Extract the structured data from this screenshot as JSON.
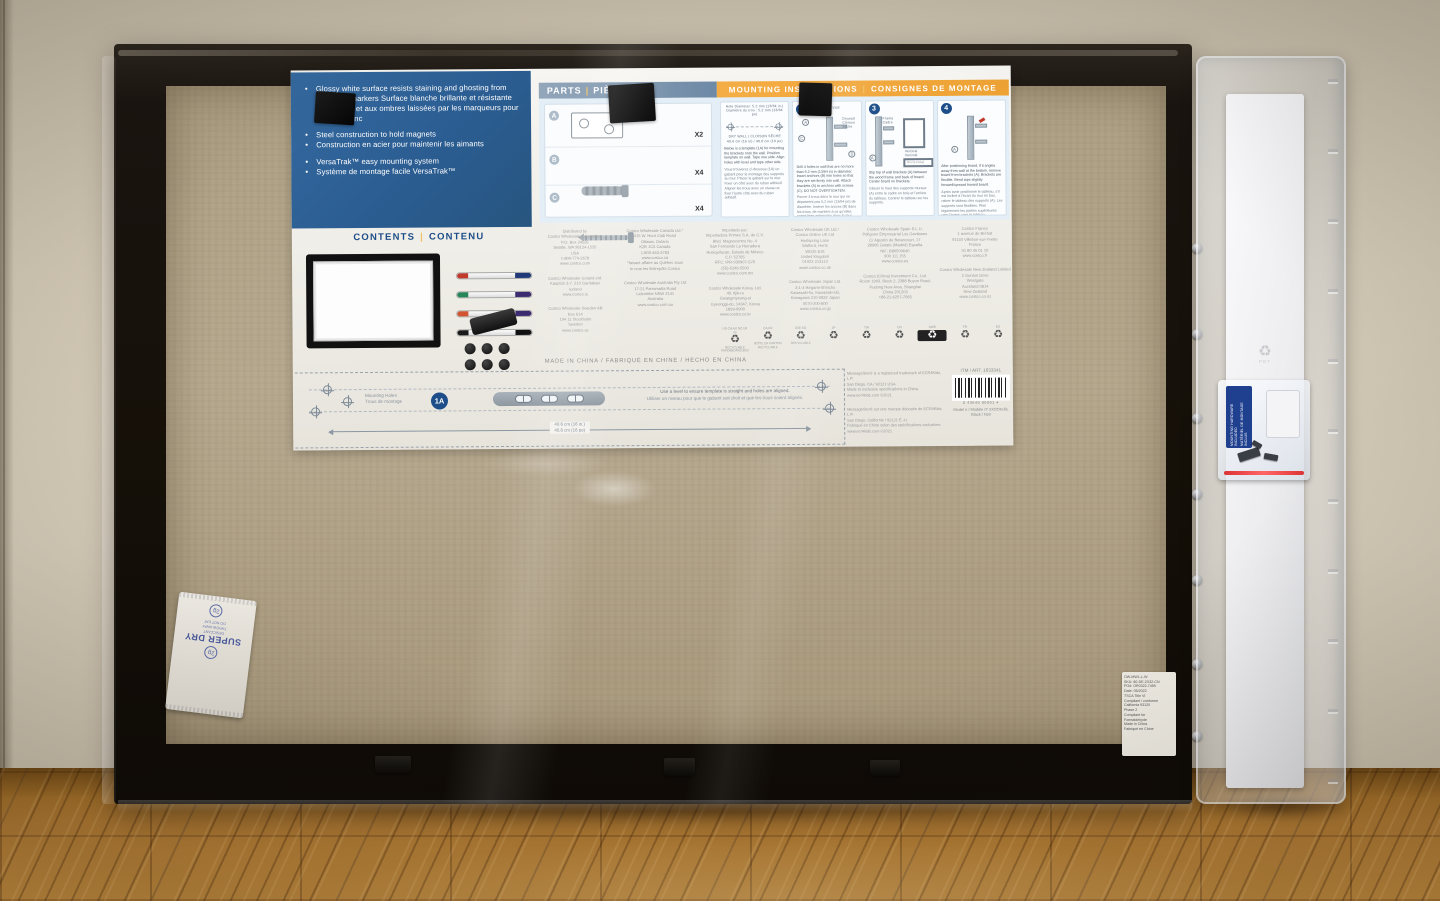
{
  "colors": {
    "panel_blue": "#2d5f95",
    "header_orange": "#f2a93b",
    "navy_accent": "#1d4e89",
    "gold_separator": "#e2a23c",
    "wall": "#cdc3b1",
    "floor_wood": "#a9752f",
    "cardboard_backing": "#b2a48b",
    "frame_black": "#151008"
  },
  "blue_panel": {
    "bullets": [
      "Glossy white surface resists staining and ghosting from dry erase markers  Surface blanche brillante et résistante aux taches et aux ombres laissées par les marqueurs pour tableau blanc",
      "Steel construction to hold magnets",
      "Construction en acier pour maintenir les aimants",
      "VersaTrak™ easy mounting system",
      "Système de montage facile VersaTrak™"
    ]
  },
  "parts": {
    "title_en": "PARTS",
    "sep": "|",
    "title_fr": "PIÈCES",
    "items": [
      {
        "letter": "A",
        "qty": "X2"
      },
      {
        "letter": "B",
        "qty": "X4"
      },
      {
        "letter": "C",
        "qty": "X4"
      }
    ]
  },
  "mounting": {
    "title_en": "MOUNTING INSTRUCTIONS",
    "sep": "|",
    "title_fr": "CONSIGNES DE MONTAGE",
    "step1": {
      "hole_en": "Hole Diameter: 5.2 mm (13/64 in.)",
      "hole_fr": "Diamètre du trou : 5,2 mm (13/64 po)",
      "drywall": "DRY WALL | CLOISON SÈCHE",
      "dim": "40.6 cm (16 in) / 40,6 cm (16 po)",
      "text_en": "Below is a template (1A) for mounting the brackets onto the wall. Position template on wall. Tape one side. Align holes with level and tape other side.",
      "text_fr": "Vous trouverez ci-dessous (1A) un gabarit pour le montage des supports au mur. Placer le gabarit sur le mur. Fixer un côté avec du ruban adhésif. Aligner les trous avec un niveau et fixer l'autre côté avec du ruban adhésif."
    },
    "steps": [
      {
        "num": "2",
        "caption": "SIDE VIEW | VUE LATÉRALE",
        "label_a": "A",
        "label_b": "B",
        "label_c": "C",
        "label_wall": "Drywall\nCloison sèche",
        "text_en": "Drill 4 holes in wall that are no more than 5.2 mm (13/64 in) in diameter. Insert anchors (B) into holes so that they are set firmly into wall. Attach brackets (A) to anchors with screws (C). DO NOT OVERTIGHTEN.",
        "text_fr": "Percer 4 trous dans le mur qui ne dépassent pas 5,2 mm (13/64 po) de diamètre. Insérer les ancres (B) dans les trous, de manière à ce qu'elles soient bien enfoncées dans le mur. Fixer les supports (A) aux ancres avec les vis (C). NE PAS TROP SERRER."
      },
      {
        "num": "3",
        "label_frame": "Frame\nCadre",
        "label_board": "Board\nTableau",
        "label_a": "A",
        "label_vertical": "Vertical\nVertical",
        "label_horizontal": "Horizontal\nHorizontal",
        "text_en": "Slip top of wall brackets (A) between the wood frame and back of board. Center board on brackets.",
        "text_fr": "Glisser le haut des supports muraux (A) entre le cadre en bois et l'arrière du tableau. Centrer le tableau sur les supports."
      },
      {
        "num": "4",
        "label_a": "A",
        "text_en": "After positioning board, if it angles away from wall at the bottom, remove board from brackets (A). Brackets are flexible. Bend tops slightly forward/upward toward board.",
        "text_fr": "Après avoir positionné le tableau, s'il est incliné à l'écart du mur en bas, retirer le tableau des supports (A). Les supports sont flexibles. Plier légèrement les parties supérieures vers l'avant, vers le tableau."
      }
    ]
  },
  "contents": {
    "title_en": "CONTENTS",
    "sep": "|",
    "title_fr": "CONTENU",
    "markers": [
      {
        "cap": "#c0392b",
        "end": "#203a79"
      },
      {
        "cap": "#27865a",
        "end": "#3d2b70"
      },
      {
        "cap": "#d35430",
        "end": "#3d2b70"
      },
      {
        "cap": "#1a1a1a",
        "end": "#111111"
      }
    ]
  },
  "distributors": [
    [
      "Distributed by\nCostco Wholesale Corporation\nP.O. Box 34535\nSeattle, WA 98124-1535\nUSA\n1-800-774-2678\nwww.costco.com",
      "Costco Wholesale Iceland ehf.\nKauptún 3-7, 210 Garðabær\nIceland\nwww.costco.is",
      "Costco Wholesale Sweden AB\nBox 614\n194 11 Stockholm\nSweden\nwww.costco.se"
    ],
    [
      "Costco Wholesale Canada Ltd.*\n415 W. Hunt Club Road\nOttawa, Ontario\nK2E 1C5 Canada\n1-800-463-3783\nwww.costco.ca\n*faisant affaire au Québec sous\nle nom les Entrepôts Costco",
      "Costco Wholesale Australia Pty Ltd\n17-21 Parramatta Road\nLidcombe NSW 2141\nAustralia\nwww.costco.com.au"
    ],
    [
      "Importado por:\nImportadora Primex S.A. de C.V.\nBlvd. Magnocentro No. 4\nSan Fernando La Herradura\nHuixquilucan, Estado de México\nC.P. 52765\nRFC: IPR-930907-S70\n(55)-5246-5500\nwww.costco.com.mx",
      "Costco Wholesale Korea, Ltd.\n40, Iljik-ro\nGwangmyeong-si\nGyeonggi-do, 14347, Korea\n1899-9900\nwww.costco.co.kr"
    ],
    [
      "Costco Wholesale UK Ltd /\nCostco Online UK Ltd\nHartspring Lane\nWatford, Herts\nWD25 8JS\nUnited Kingdom\n01923 213113\nwww.costco.co.uk",
      "Costco Wholesale Japan Ltd.\n3-1-4 Ikegami-Shincho\nKawasaki-ku, Kawasaki-shi,\nKanagawa 210-0832 Japan\n0570-200-800\nwww.costco.co.jp"
    ],
    [
      "Costco Wholesale Spain S.L.U.\nPolígono Empresarial Los Gavilanes\nC/ Agustín de Betancourt, 17\n28906 Getafe (Madrid) España\nNIF: B86509640\n900 111 155\nwww.costco.es",
      "Costco (China) Investment Co., Ltd.\nRoom 1903, Block 2, 2388 Boyun Road,\nPudong New Area, Shanghai\nChina 201203\n+86-21-6257-7065"
    ],
    [
      "Costco France\n1 avenue de Bréhat\n91140 Villebon-sur-Yvette\nFrance\n01 80 45 01 10\nwww.costco.fr",
      "Costco Wholesale New Zealand Limited\n2 Gunton Drive\nWestgate\nAuckland 0814\nNew Zealand\nwww.costco.co.nz"
    ]
  ],
  "made_in": "MADE IN CHINA / FABRIQUÉ EN CHINE / HECHO EN CHINA",
  "recycle": {
    "icon": "♻",
    "items": [
      {
        "codes": "US CA AU NZ UK IS",
        "caption": "RECYCLABLE\nPAPERBOARD BOX"
      },
      {
        "codes": "CA FR",
        "caption": "BOÎTE EN CARTON\nRECYCLABLE"
      },
      {
        "codes": "IRE KR",
        "caption": "RECYCLABLE"
      },
      {
        "codes": "JP",
        "caption": ""
      },
      {
        "codes": "TW",
        "caption": ""
      },
      {
        "codes": "CN",
        "caption": ""
      },
      {
        "codes": "SWE",
        "caption": ""
      },
      {
        "codes": "FR",
        "caption": ""
      },
      {
        "codes": "ES",
        "caption": ""
      }
    ]
  },
  "template_strip": {
    "holes_label": "Mounting Holes\nTrous de montage",
    "badge": "1A",
    "note_en": "Use a level to ensure template is straight and holes are aligned.",
    "note_fr": "Utiliser un niveau pour que le gabarit soit droit et que les trous soient alignés.",
    "dim_en": "40.6 cm (16 in.)",
    "dim_fr": "40,6 cm (16 po)"
  },
  "legal": {
    "en": "MessageStor® is a registered trademark of ECR4Kids, L.P.\nSan Diego, CA / 92121 USA\nMade to exclusive specifications in China.\nwww.ecr4kids.com  ©2021",
    "fr": "MessageStor® est une marque déposée de ECR4Kids, L.P.\nSan Diego, Californie / 92121 É.-U.\nFabriqué en Chine selon des spécifications exclusives.\nwww.ecr4kids.com  ©2021",
    "itm": "ITM / ART. 1633341",
    "barcode_digits": "0  43640  06001  4",
    "model": "Model # / Modèle nº 2XOON-BL\nBlack / Noir"
  },
  "desiccant": {
    "brand": "SUPER DRY",
    "weight": "2g",
    "note": "DESICCANT\nTHROW AWAY\nDO NOT EAT"
  },
  "hardware_bag": {
    "line1": "MOUNTING HARDWARE INCLUDED",
    "line2": "MATÉRIEL DE MONTAGE INCLUS"
  },
  "blister": {
    "emboss_tri": "♻",
    "emboss_code": "PET"
  },
  "frame_label": "OW-MWL-L-W\nSKU: 80-DE-2X32-CN\nPO#: OR0322-7459\nDate: 05/2022\nTSCA Title VI\nCompliant / conforme\nCalifornia 93120\nPhase 2\nCompliant for\nFormaldehyde\nMade in China\nFabriqué en Chine"
}
